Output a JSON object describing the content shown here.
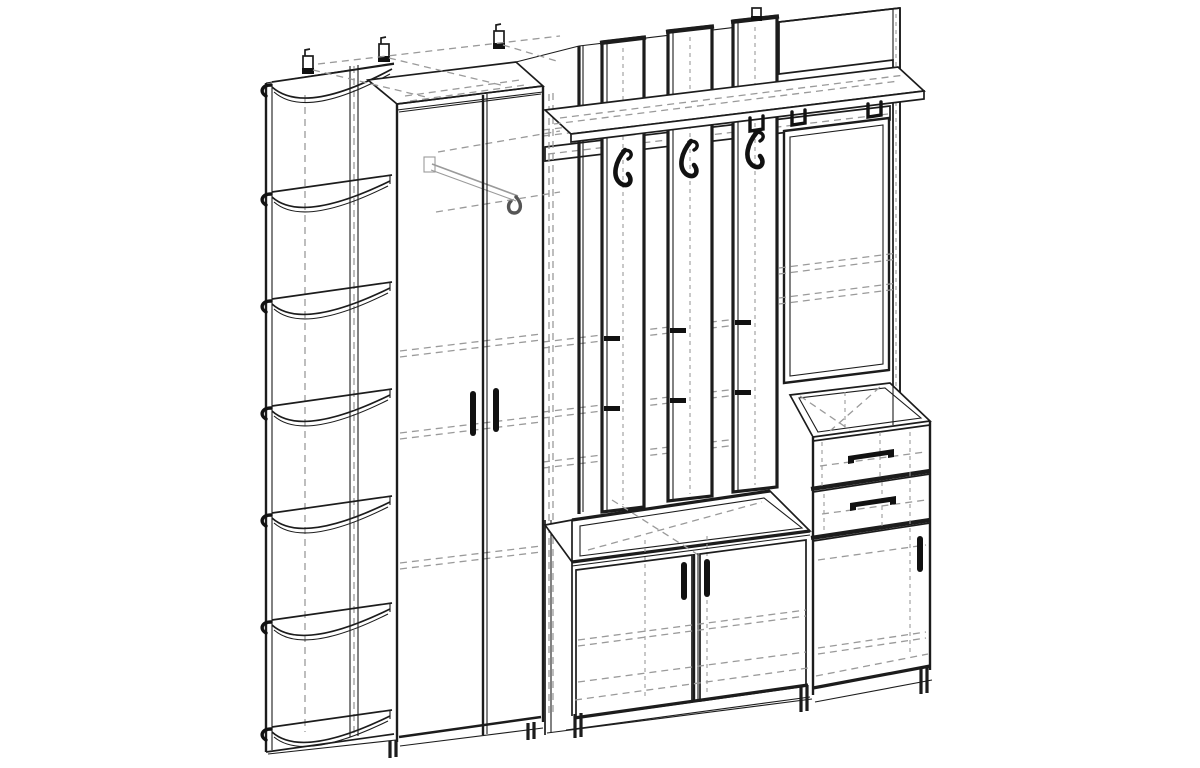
{
  "page": {
    "title": "Hallway furniture set — isometric technical line drawing",
    "background": "#ffffff"
  },
  "style": {
    "line_color": "#1c1c1c",
    "hidden_line_color": "#9a9a9a",
    "paper_color": "#ffffff",
    "hardware_color": "#111111"
  },
  "drawing": {
    "type": "technical line drawing, black ink on white, no text or dimensions",
    "components": {
      "corner_shelf_unit": {
        "label": "Corner open shelf unit with curved quarter-round shelves",
        "shelf_count": 7
      },
      "wardrobe": {
        "label": "Two-door wardrobe with pull-out hanger (hidden lines)",
        "door_count": 2
      },
      "coat_rack": {
        "label": "Coat-rack wall with three vertical slats and three double hooks",
        "slat_count": 3,
        "hook_count": 3
      },
      "hat_shelf": {
        "label": "Top hat shelf with under-rail and mounting clips",
        "clip_count": 3
      },
      "mirror": {
        "label": "Framed mirror on tall back panel"
      },
      "drawer_unit": {
        "label": "Open-top chest module with two drawers",
        "drawer_count": 2
      },
      "right_cabinet": {
        "label": "Single-door base cabinet under drawers",
        "door_count": 1
      },
      "bench_cabinet": {
        "label": "Two-door base bench cabinet",
        "door_count": 2
      },
      "wall_brackets": {
        "label": "Wall mounting brackets",
        "count": 4
      },
      "feet": {
        "label": "Adjustable feet",
        "count": 5
      }
    }
  }
}
